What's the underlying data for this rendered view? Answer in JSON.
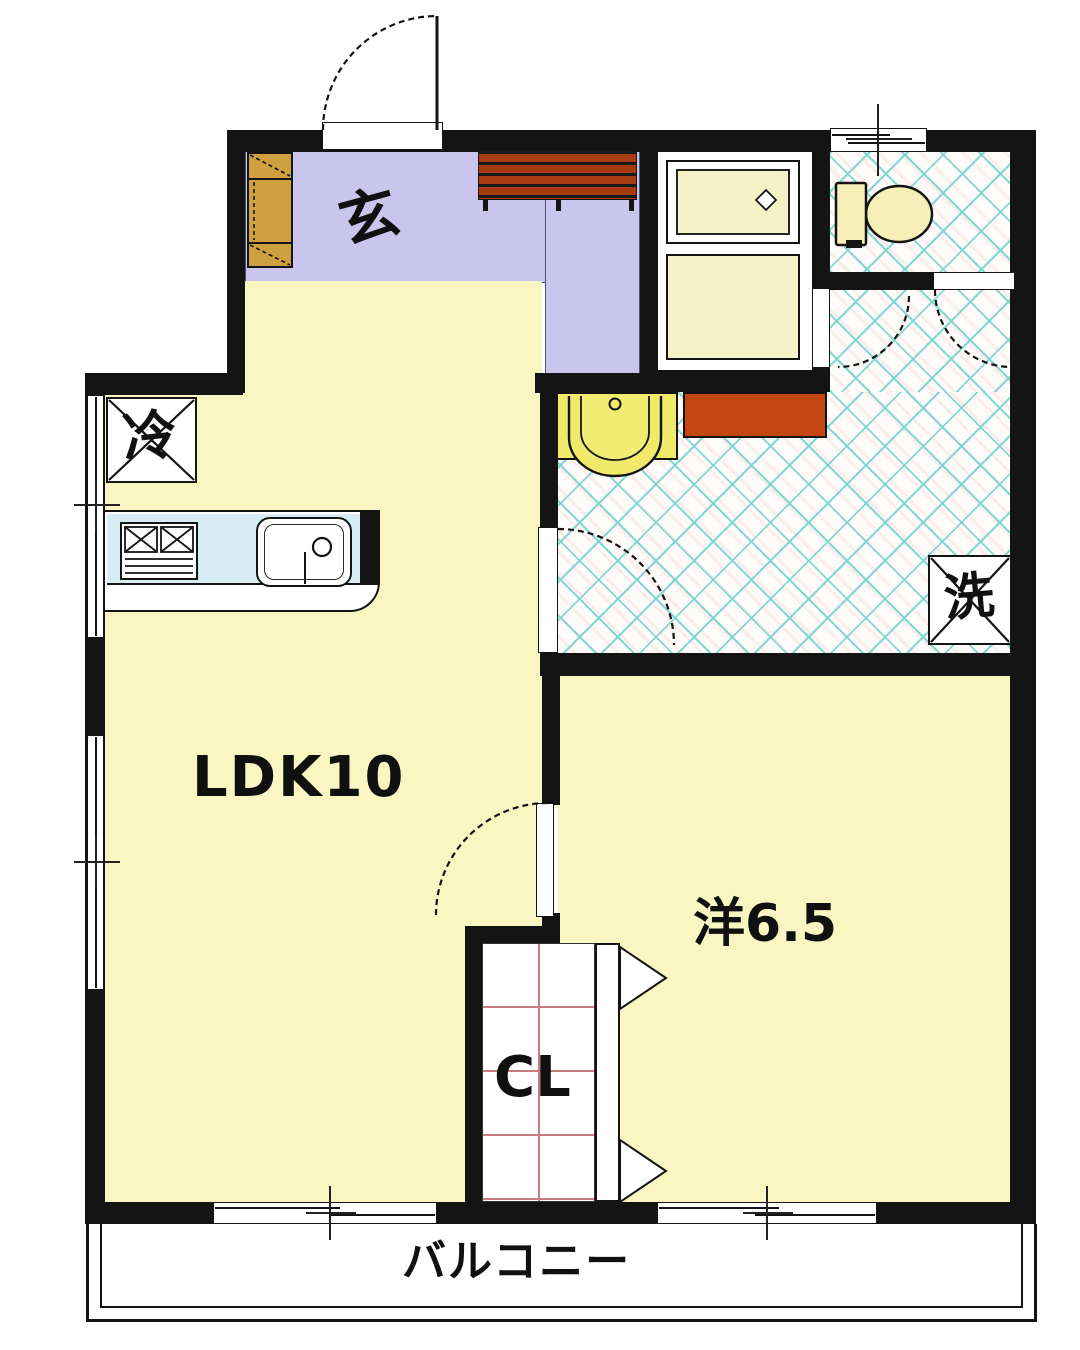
{
  "floor_plan": {
    "rooms": {
      "entrance_label": "玄",
      "living_label": "LDK10",
      "western_room_label": "洋6.5",
      "closet_label": "CL",
      "balcony_label": "バルコニー",
      "refrigerator_label": "冷",
      "laundry_label": "洗"
    },
    "colors": {
      "wall": "#141414",
      "room_yellow": "#faf6c2",
      "entrance_lavender": "#c9c5ec",
      "tile_line_cyan": "#76d4ce",
      "wood_brown": "#a83b10",
      "counter_red": "#c44612",
      "fixture_cream": "#f6f2c8",
      "basin_yellow": "#f0e96a",
      "cabinet_tan": "#cfa03f",
      "kitchen_counter_blue": "#d8edf3",
      "closet_grid_pink": "#c97c7c"
    }
  }
}
